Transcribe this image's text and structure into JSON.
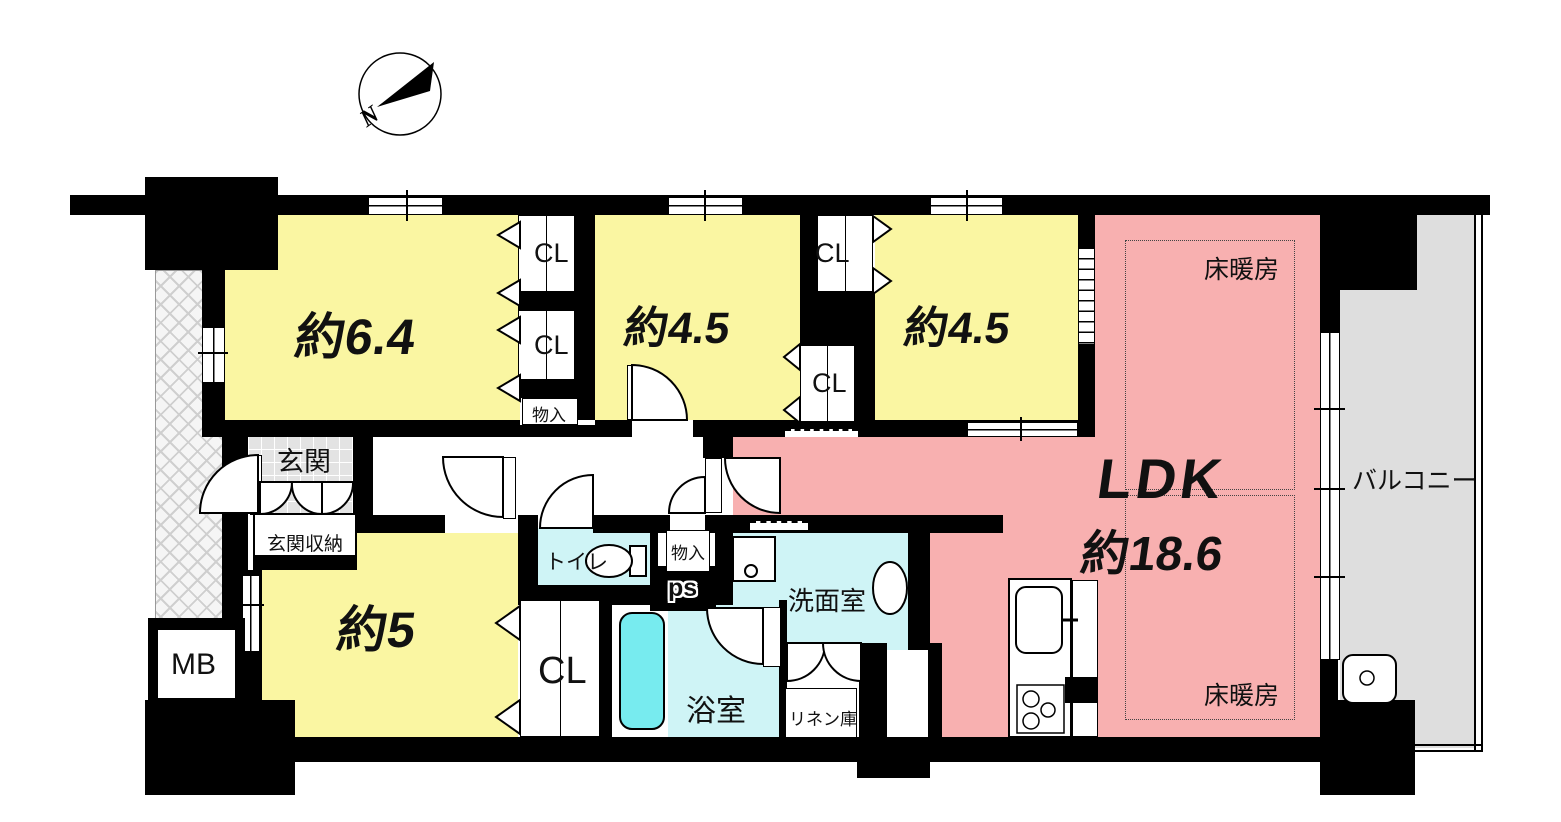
{
  "labels": {
    "room_6_4": "約6.4",
    "room_4_5": "約4.5",
    "room_5": "約5",
    "ldk": "LDK",
    "ldk_size": "約18.6",
    "floor_heating": "床暖房",
    "balcony": "バルコニー",
    "entrance": "玄関",
    "entrance_storage": "玄関収納",
    "toilet": "トイレ",
    "bathroom": "浴室",
    "washroom": "洗面室",
    "linen_closet": "リネン庫",
    "closet": "CL",
    "storage": "物入",
    "meter_box": "MB",
    "pipe_space": "ps",
    "compass_north": "N"
  },
  "colors": {
    "wall": "#000000",
    "bedroom_fill": "#FAF6A2",
    "ldk_fill": "#F8B0B0",
    "wet_area_fill": "#CFF4F6",
    "bathtub_fill": "#77EBEF",
    "balcony_fill": "#DEDEDE",
    "entrance_tile": "#E3E3E3"
  }
}
